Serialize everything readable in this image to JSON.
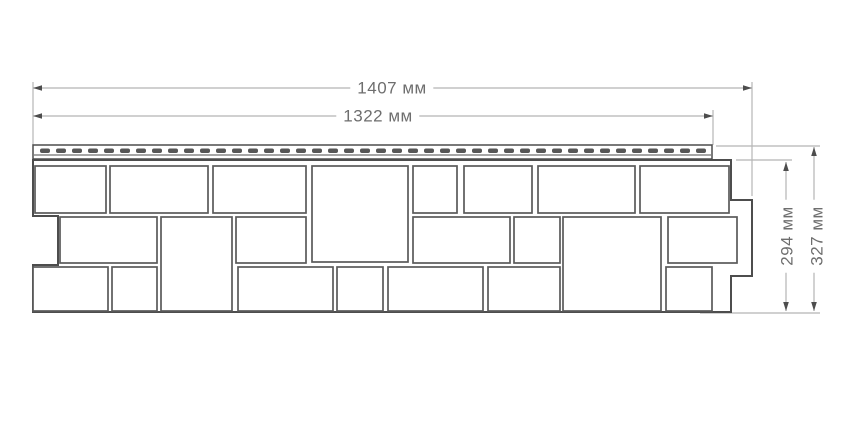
{
  "figure": {
    "type": "technical-drawing",
    "subject": "facade-siding-panel-with-stone-block-pattern",
    "unit": "мм"
  },
  "dimensions": {
    "total_width": {
      "label": "1407 мм",
      "value": 1407,
      "unit": "мм",
      "orientation": "horizontal"
    },
    "useful_width": {
      "label": "1322 мм",
      "value": 1322,
      "unit": "мм",
      "orientation": "horizontal"
    },
    "useful_height": {
      "label": "294 мм",
      "value": 294,
      "unit": "мм",
      "orientation": "vertical"
    },
    "total_height": {
      "label": "327 мм",
      "value": 327,
      "unit": "мм",
      "orientation": "vertical"
    }
  },
  "colors": {
    "outline": "#4d4d4d",
    "block_stroke": "#5a5a5a",
    "perforation": "#565656",
    "dim_line": "#b5b5b5",
    "text": "#6e6e6e",
    "background": "#ffffff"
  },
  "geometry": {
    "panel_outline": [
      [
        33,
        160
      ],
      [
        731,
        160
      ],
      [
        731,
        200
      ],
      [
        752,
        200
      ],
      [
        752,
        276
      ],
      [
        731,
        276
      ],
      [
        731,
        312
      ],
      [
        33,
        312
      ],
      [
        33,
        265
      ],
      [
        58,
        265
      ],
      [
        58,
        216
      ],
      [
        33,
        216
      ]
    ],
    "nail_strip": {
      "x": 33,
      "y": 145,
      "w": 679,
      "h": 14,
      "inner_line_y": 155,
      "perforations": {
        "x_start": 40,
        "pitch": 16,
        "count": 42,
        "w": 10,
        "h": 4.5,
        "y": 148.5,
        "rx": 2
      }
    },
    "blocks": [
      [
        35,
        166,
        71,
        47
      ],
      [
        110,
        166,
        98,
        47
      ],
      [
        213,
        166,
        93,
        47
      ],
      [
        413,
        166,
        44,
        47
      ],
      [
        464,
        166,
        68,
        47
      ],
      [
        538,
        166,
        97,
        47
      ],
      [
        640,
        166,
        89,
        47
      ],
      [
        312,
        166,
        96,
        96
      ],
      [
        60,
        217,
        97,
        46
      ],
      [
        236,
        217,
        70,
        46
      ],
      [
        413,
        217,
        97,
        46
      ],
      [
        514,
        217,
        46,
        46
      ],
      [
        668,
        217,
        69,
        46
      ],
      [
        161,
        217,
        71,
        94
      ],
      [
        563,
        217,
        98,
        94
      ],
      [
        33,
        267,
        75,
        44
      ],
      [
        112,
        267,
        45,
        44
      ],
      [
        238,
        267,
        95,
        44
      ],
      [
        337,
        267,
        46,
        44
      ],
      [
        388,
        267,
        95,
        44
      ],
      [
        488,
        267,
        72,
        44
      ],
      [
        666,
        267,
        46,
        44
      ]
    ],
    "extension_lines": [
      [
        33,
        82,
        33,
        145
      ],
      [
        713,
        110,
        713,
        145
      ],
      [
        752,
        82,
        752,
        196
      ],
      [
        716,
        146,
        820,
        146
      ],
      [
        736,
        160,
        792,
        160
      ],
      [
        700,
        313,
        820,
        313
      ]
    ],
    "dim_lines": [
      {
        "x1": 33,
        "y1": 88,
        "x2": 752,
        "y2": 88
      },
      {
        "x1": 33,
        "y1": 116,
        "x2": 713,
        "y2": 116
      },
      {
        "x1": 786,
        "y1": 162,
        "x2": 786,
        "y2": 311
      },
      {
        "x1": 814,
        "y1": 147,
        "x2": 814,
        "y2": 311
      }
    ],
    "label_anchors": {
      "total_width": {
        "x": 392,
        "y": 88
      },
      "useful_width": {
        "x": 378,
        "y": 116
      },
      "useful_height": {
        "x": 787,
        "y": 236
      },
      "total_height": {
        "x": 817,
        "y": 236
      }
    }
  }
}
